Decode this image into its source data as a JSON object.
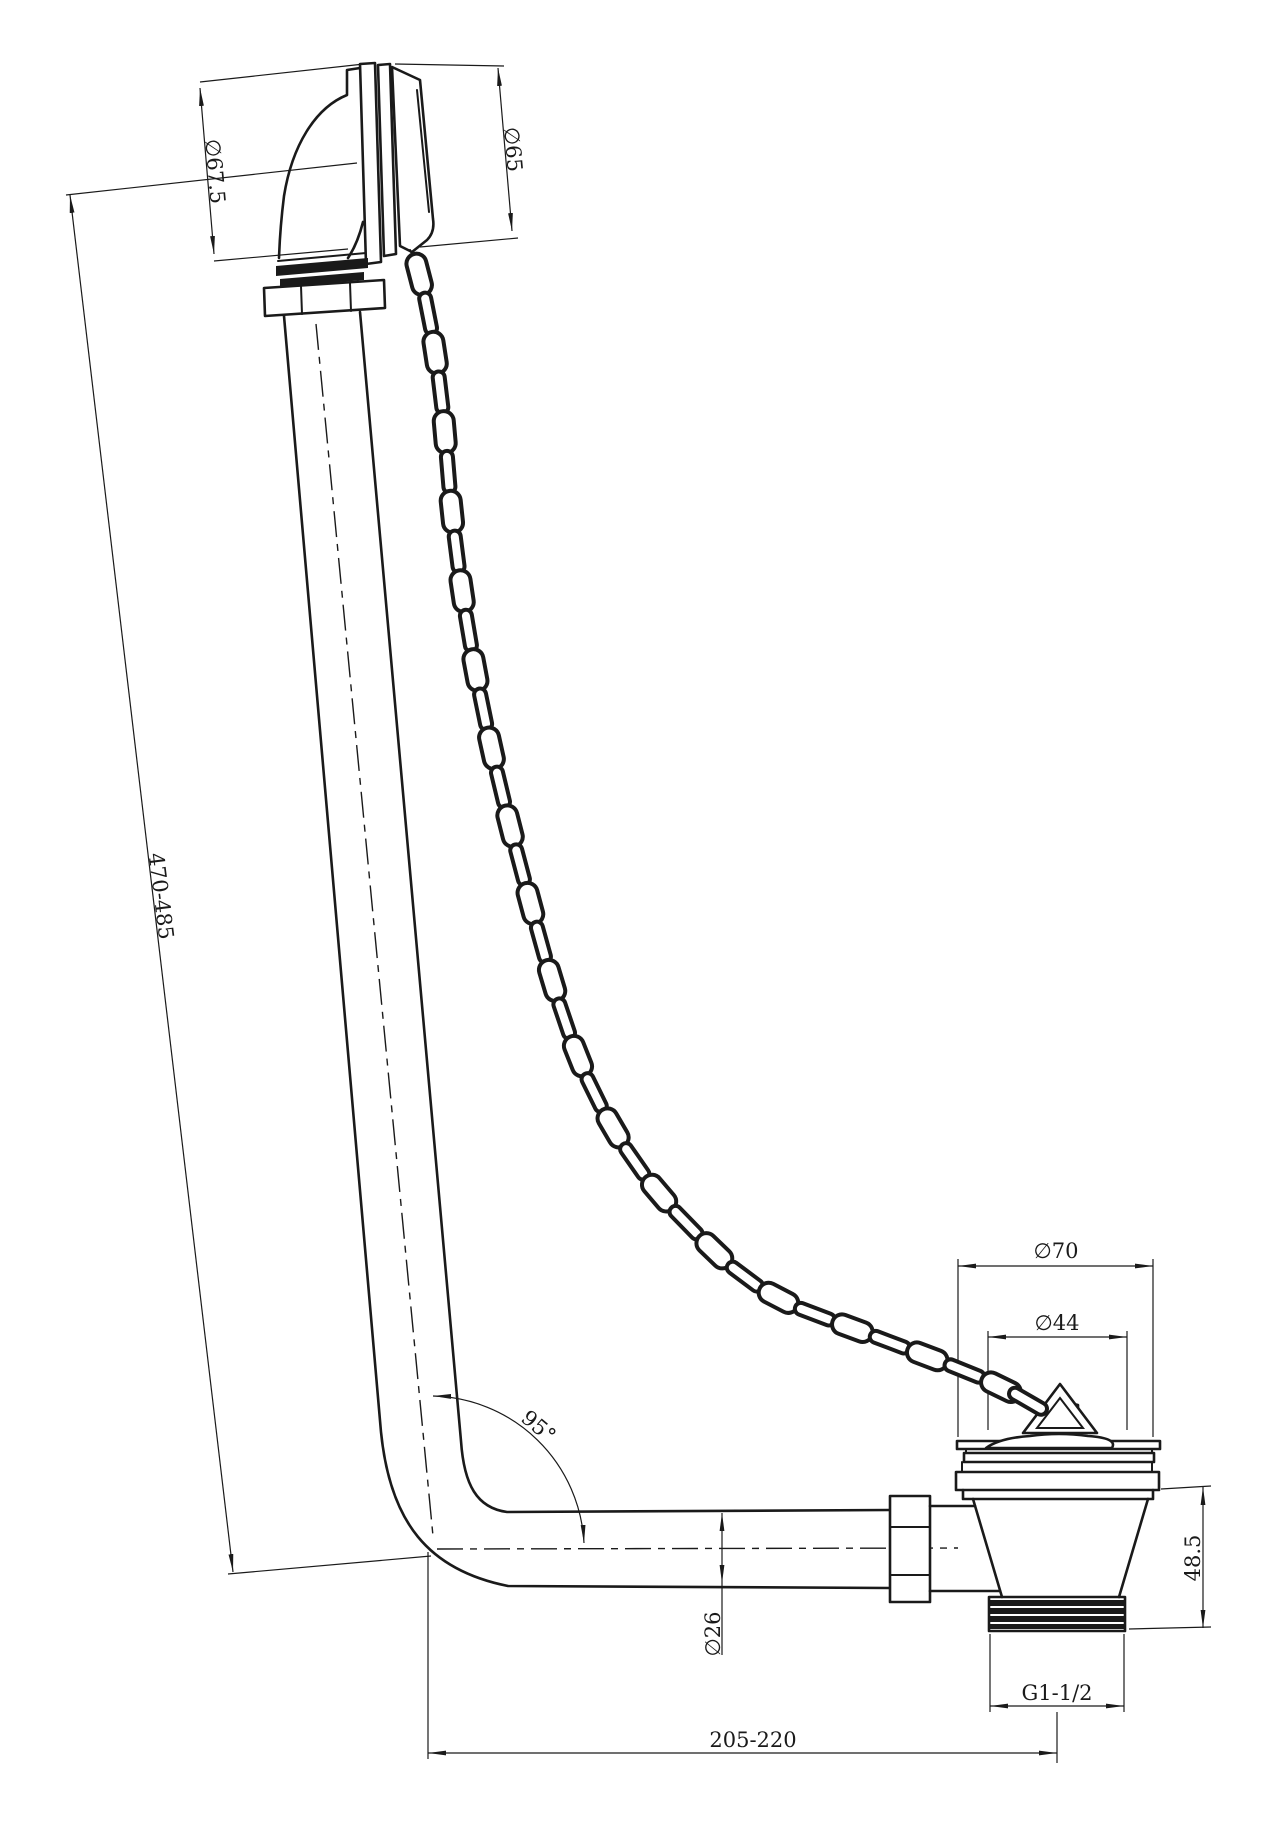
{
  "drawing": {
    "type": "technical-drawing",
    "subject": "bath-waste-overflow-assembly",
    "colors": {
      "line": "#1a1a1a",
      "background": "#ffffff"
    },
    "dimensions": {
      "overflow_face_width": "∅67.5",
      "overflow_cover_diameter": "∅65",
      "overflow_pipe_length": "470-485",
      "bend_angle": "95°",
      "pipe_diameter": "∅26",
      "waste_flange_diameter": "∅70",
      "plug_diameter": "∅44",
      "waste_body_height": "48.5",
      "outlet_thread": "G1-1/2",
      "horizontal_run": "205-220"
    }
  }
}
